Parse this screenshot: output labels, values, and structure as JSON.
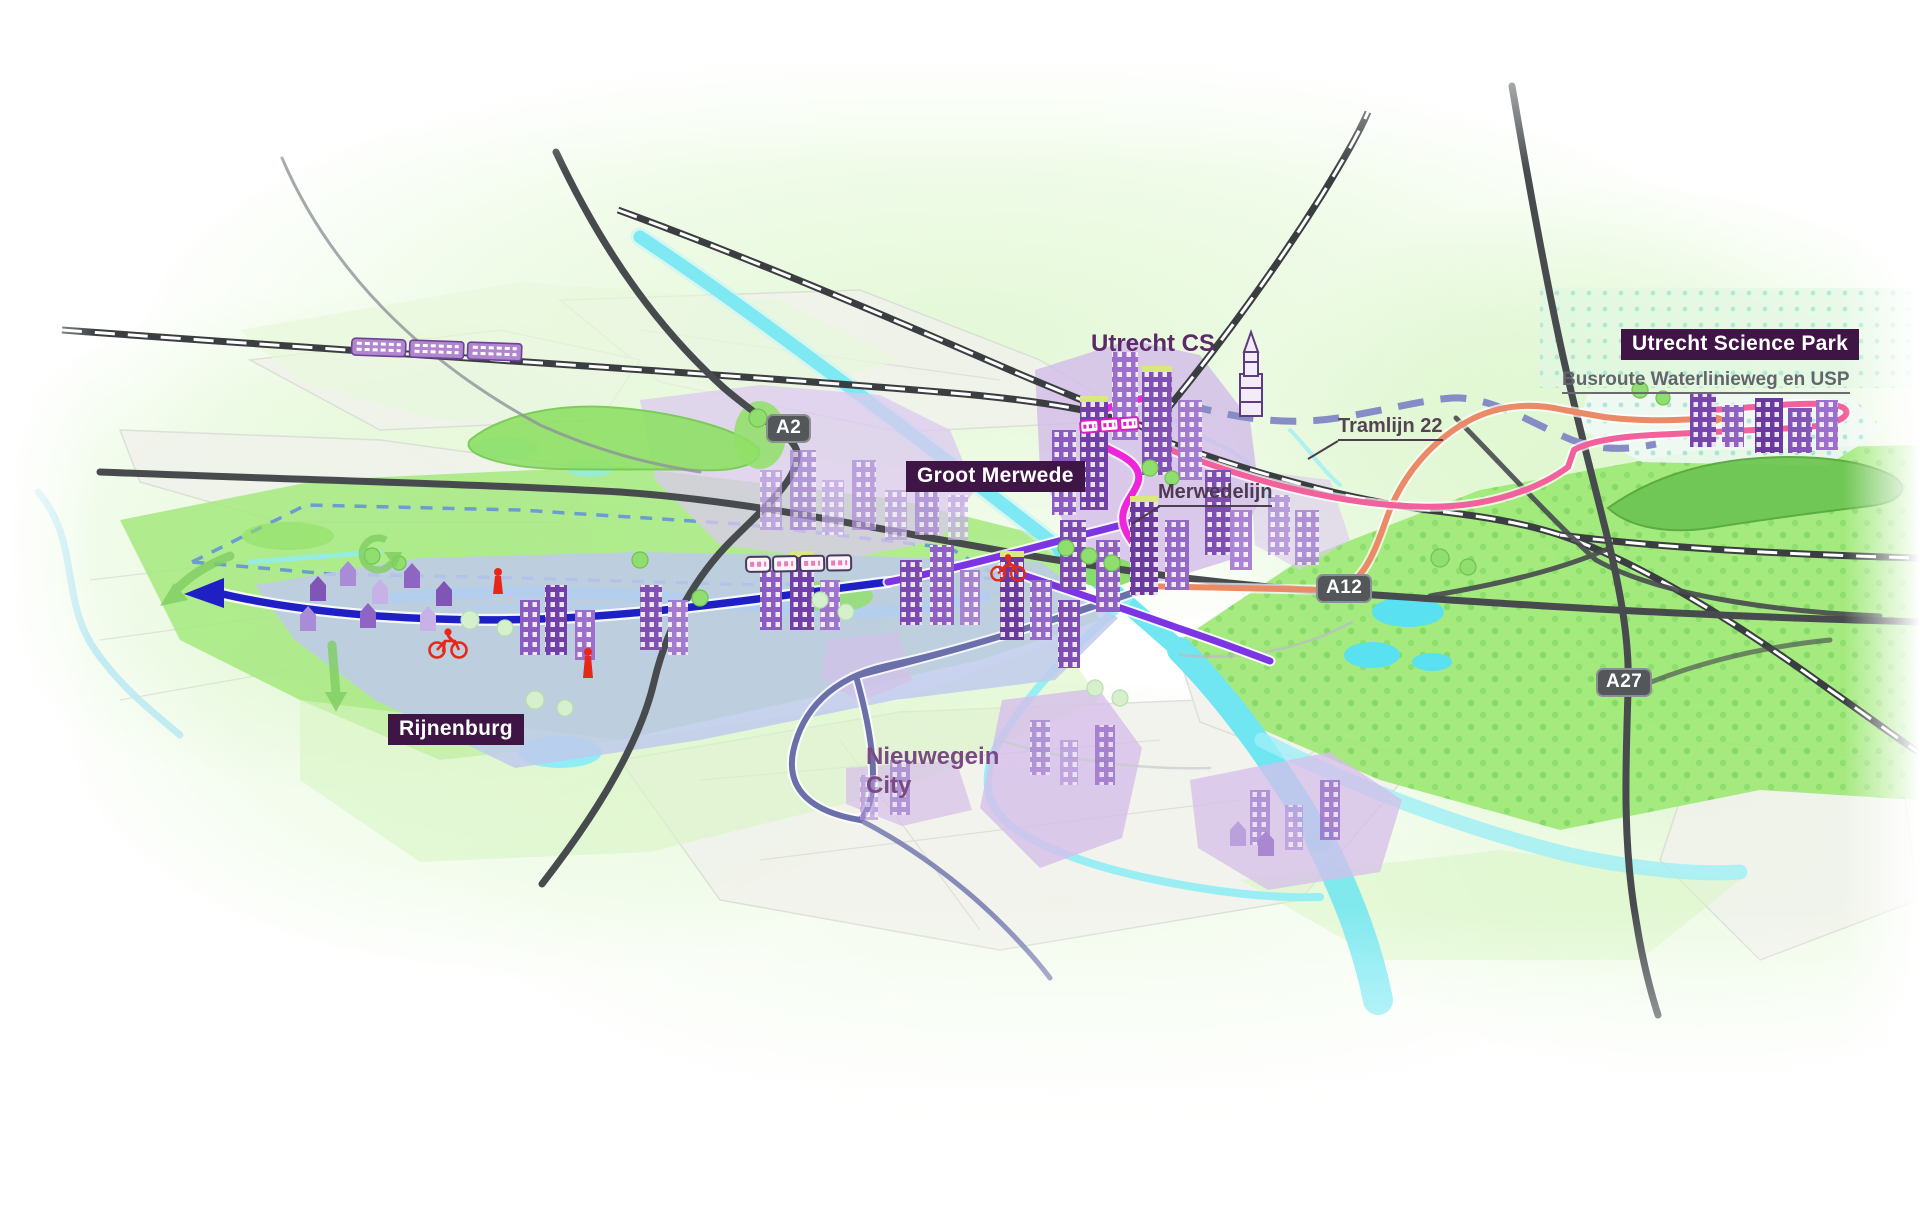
{
  "labels": {
    "utrecht_cs": "Utrecht CS",
    "utrecht_science_park": "Utrecht Science Park",
    "groot_merwede": "Groot Merwede",
    "rijnenburg": "Rijnenburg",
    "nieuwegein_line1": "Nieuwegein",
    "nieuwegein_line2": "City",
    "merwedelijn": "Merwedelijn",
    "tramlijn_22": "Tramlijn 22",
    "busroute": "Busroute Waterlinieweg en USP"
  },
  "highway_badges": [
    {
      "id": "a2",
      "label": "A2"
    },
    {
      "id": "a12",
      "label": "A12"
    },
    {
      "id": "a27",
      "label": "A27"
    }
  ],
  "route_colors": {
    "merwedelijn": "#EF25DB",
    "tramlijn_22": "#F2619B",
    "busroute_dashed": "#868CC6",
    "blue_cycle_route": "#1E20C6",
    "purple_route": "#7D35E3",
    "slate_nieuwegein_loop": "#6B70AA",
    "orange_route": "#EB8A67"
  },
  "icons": {
    "dom_tower": "dom-tower-icon",
    "train": "train-icon",
    "tram": "tram-icon",
    "bicycle": "bicycle-icon",
    "pedestrian": "pedestrian-icon"
  },
  "colors": {
    "label_box_bg": "#3F1546",
    "label_box_text": "#FFFFFF",
    "area_label_purple": "#5B2A68",
    "pointer_label_gray": "#544452",
    "busroute_label_gray": "#64646C",
    "highway_badge_bg": "#53575A",
    "water": "#6FE6F2",
    "railway": "#3A3E41",
    "highway": "#474B4E",
    "field_green": "#9CE873",
    "district_lavender": "#D6BEEA",
    "district_periwinkle": "#C0CAEC"
  }
}
